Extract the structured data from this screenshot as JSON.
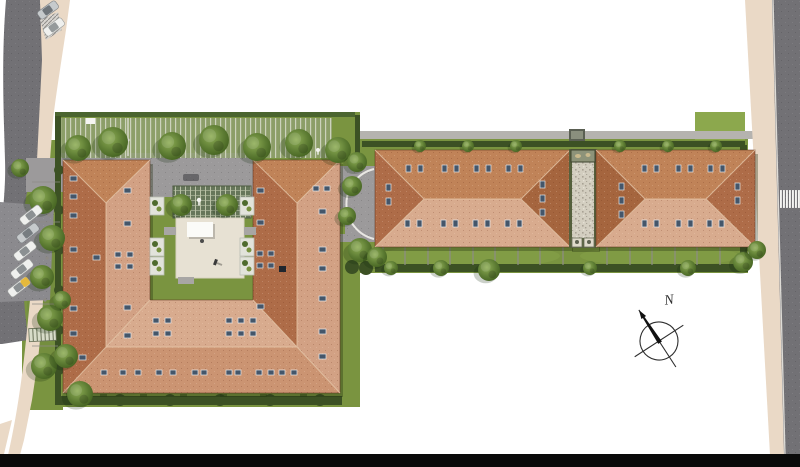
{
  "compass": {
    "north_label": "N"
  },
  "palette": {
    "background": "#ffffff",
    "road": "#727175",
    "road_light": "#8b8a8e",
    "drive": "#9c9a9b",
    "sidewalk": "#ead9c6",
    "lawn": "#7a9440",
    "lawn_light": "#8ca84d",
    "lawn_dark": "#67823a",
    "hedge": "#3c5124",
    "hedge_light": "#4b6530",
    "tree_light": "#8fae56",
    "tree_mid": "#5d7c33",
    "tree_dark": "#42601f",
    "roof_dark": "#ae6c48",
    "roof_light": "#d2a184",
    "roof_mid": "#c08358",
    "roof_pale": "#d8ab8e",
    "roof_south": "#cb9472",
    "roof_hip_dark": "#a5653e",
    "roof_ridge": "#e6c6a9",
    "skylight": "#44566a",
    "skylight_edge": "#e8e8e8",
    "courtyard_paving": "#e7e1d3",
    "canopy": "#fbfbf8",
    "gravel": "#d3cec0",
    "gravel_dot": "#a9a396",
    "pergola": "#66765a",
    "pergola_line": "#b9c1a6",
    "stall_base": "#8fa070",
    "stall_line": "#ccd2bc",
    "crosswalk": "#f4f4f2",
    "footer_bar": "#0a0a0a",
    "compass_ink": "#2e2e2e",
    "car_white": "#eff0ee",
    "car_silver": "#c6cacc",
    "car_gray": "#9aa0a3",
    "car_yellow": "#e5b93c",
    "fence": "#8e8c86"
  },
  "site": {
    "buildings_count": 2,
    "u_building_sections": 3,
    "long_building_sections": 2,
    "parked_cars_west": 5,
    "parked_cars_north": 2,
    "crosswalk_stripes": 7
  }
}
